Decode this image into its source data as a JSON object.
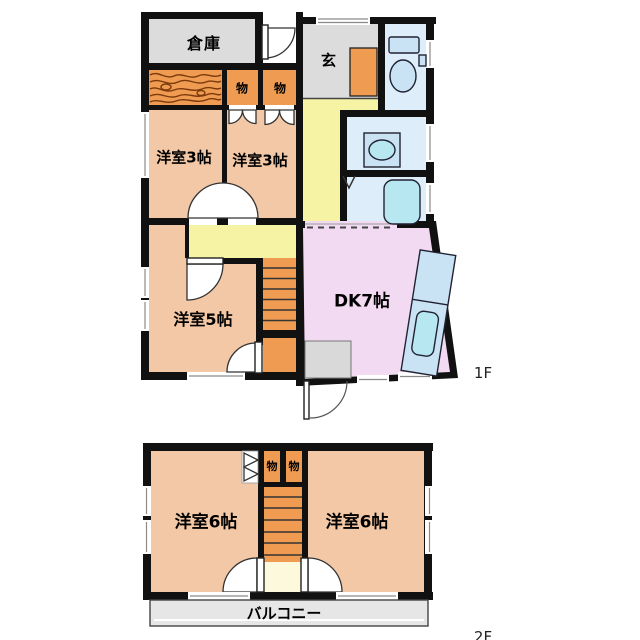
{
  "title": "2-story house floor plan",
  "colors": {
    "wall": "#111111",
    "room_salmon": "#f2c8a6",
    "closet_orange": "#ef9c52",
    "hall_yellow": "#f7f3a5",
    "dk_lavender": "#f3daf3",
    "wet_blue": "#ddeefa",
    "fixture_blue": "#c9e3f4",
    "fixture_cyan": "#b7e7f0",
    "gray_room": "#dcdcdc",
    "balcony_gray": "#e6e6e6",
    "stair_landing": "#fcf9dc"
  },
  "icons": [
    "toilet-icon",
    "washbasin-icon",
    "bathtub-icon",
    "kitchen-counter-icon",
    "stairs-icon",
    "door-swing-icon",
    "double-door-icon",
    "folding-door-icon",
    "wood-grain-texture",
    "window-symbol",
    "doorstep"
  ],
  "floor1": {
    "label": "1F",
    "rooms": {
      "souko": "倉庫",
      "genkan": "玄",
      "mono1": "物",
      "mono2": "物",
      "yoshitsu3_left": "洋室3帖",
      "yoshitsu3_right": "洋室3帖",
      "yoshitsu5": "洋室5帖",
      "dk": "DK7帖"
    }
  },
  "floor2": {
    "label": "2F",
    "rooms": {
      "mono1": "物",
      "mono2": "物",
      "yoshitsu6_left": "洋室6帖",
      "yoshitsu6_right": "洋室6帖",
      "balcony": "バルコニー"
    }
  }
}
